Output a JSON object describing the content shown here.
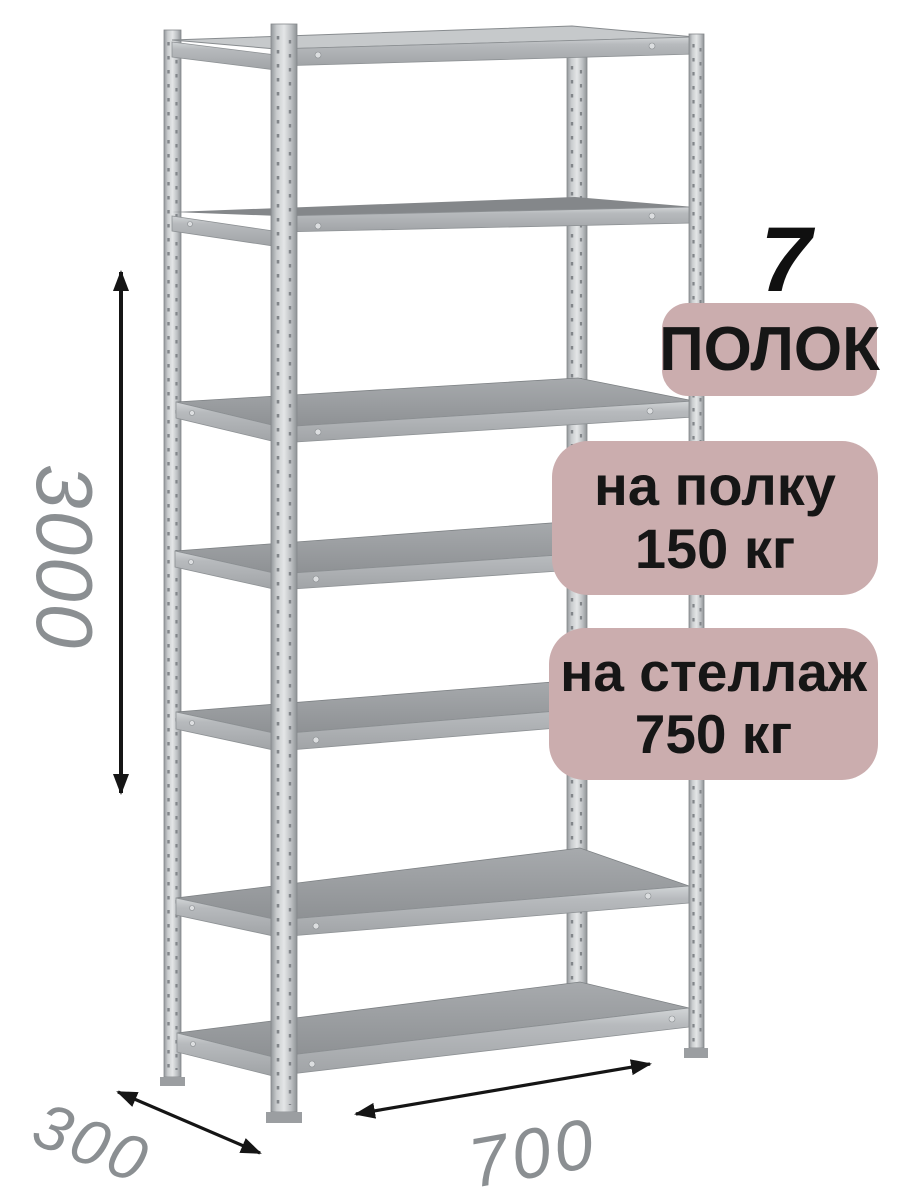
{
  "product_label": {
    "shelf_count": "7",
    "shelf_count_unit": "ПОЛОК",
    "per_shelf_line1": "на полку",
    "per_shelf_line2": "150 кг",
    "per_rack_line1": "на стеллаж",
    "per_rack_line2": "750 кг"
  },
  "dimensions": {
    "height_mm": "3000",
    "depth_mm": "300",
    "width_mm": "700"
  },
  "colors": {
    "badge_background": "#cbadae",
    "badge_text": "#161616",
    "dimension_text": "#8b8f92",
    "arrow": "#151515",
    "metal_light": "#d9dbdd",
    "metal_mid": "#b3b6b9",
    "metal_shelf": "#96999c",
    "background": "#ffffff"
  }
}
